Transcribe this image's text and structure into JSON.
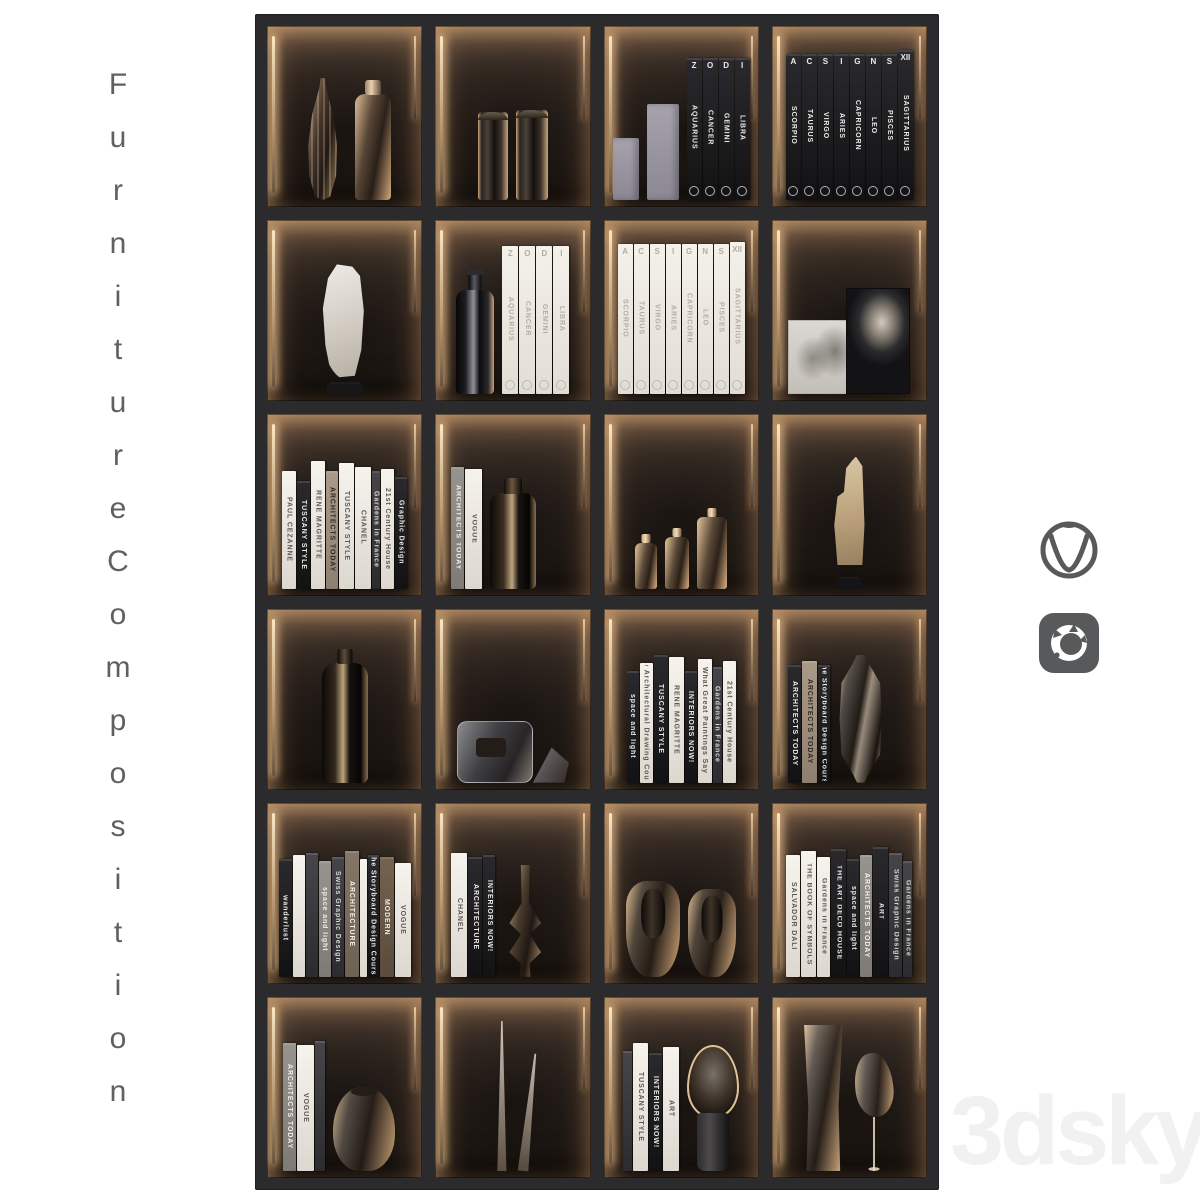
{
  "page": {
    "background": "#ffffff",
    "side_label": "Furniture Composition",
    "watermark": "3dsky"
  },
  "icons": {
    "vray": "vray-logo",
    "corona": "corona-renderer-logo"
  },
  "colors": {
    "frame": "#2b2b2d",
    "cell_glow": "#caa06e",
    "logo_gray": "#58595b",
    "label_gray": "#606060",
    "watermark_gray": "#f1f1f1"
  },
  "shelf": {
    "columns": 4,
    "rows": 6,
    "cells": [
      {
        "items": [
          {
            "k": "obj",
            "v": "amber-fluted-vase",
            "w": 48,
            "h": 122
          },
          {
            "k": "obj",
            "v": "amber-bottle",
            "w": 36,
            "h": 106
          }
        ]
      },
      {
        "items": [
          {
            "k": "obj",
            "v": "canister-dark",
            "w": 30,
            "h": 88
          },
          {
            "k": "obj",
            "v": "canister-dark",
            "w": 32,
            "h": 90
          }
        ]
      },
      {
        "items": [
          {
            "k": "obj",
            "v": "gray-box",
            "w": 26,
            "h": 62
          },
          {
            "k": "obj",
            "v": "gray-box",
            "w": 32,
            "h": 96
          },
          {
            "k": "books",
            "list": [
              {
                "t": "AQUARIUS",
                "top": "Z",
                "s": "black",
                "w": 15,
                "h": 142
              },
              {
                "t": "CANCER",
                "top": "O",
                "s": "black",
                "w": 15,
                "h": 142
              },
              {
                "t": "GEMINI",
                "top": "D",
                "s": "black",
                "w": 15,
                "h": 142
              },
              {
                "t": "LIBRA",
                "top": "I",
                "s": "black",
                "w": 15,
                "h": 142
              }
            ]
          }
        ]
      },
      {
        "items": [
          {
            "k": "books",
            "list": [
              {
                "t": "SCORPIO",
                "top": "A",
                "s": "black",
                "w": 15,
                "h": 146
              },
              {
                "t": "TAURUS",
                "top": "C",
                "s": "black",
                "w": 15,
                "h": 146
              },
              {
                "t": "VIRGO",
                "top": "S",
                "s": "black",
                "w": 15,
                "h": 146
              },
              {
                "t": "ARIES",
                "top": "I",
                "s": "black",
                "w": 15,
                "h": 146
              },
              {
                "t": "CAPRICORN",
                "top": "G",
                "s": "black",
                "w": 15,
                "h": 146
              },
              {
                "t": "LEO",
                "top": "N",
                "s": "black",
                "w": 15,
                "h": 146
              },
              {
                "t": "PISCES",
                "top": "S",
                "s": "black",
                "w": 15,
                "h": 146
              },
              {
                "t": "SAGITTARIUS",
                "top": "XII",
                "s": "black",
                "w": 15,
                "h": 150
              }
            ]
          }
        ]
      },
      {
        "items": [
          {
            "k": "obj",
            "v": "stone-slab",
            "w": 64,
            "h": 130
          }
        ]
      },
      {
        "items": [
          {
            "k": "obj",
            "v": "black-bottle",
            "w": 38,
            "h": 104
          },
          {
            "k": "books",
            "list": [
              {
                "t": "AQUARIUS",
                "top": "Z",
                "s": "zwhite",
                "w": 16,
                "h": 148
              },
              {
                "t": "CANCER",
                "top": "O",
                "s": "zwhite",
                "w": 16,
                "h": 148
              },
              {
                "t": "GEMINI",
                "top": "D",
                "s": "zwhite",
                "w": 16,
                "h": 148
              },
              {
                "t": "LIBRA",
                "top": "I",
                "s": "zwhite",
                "w": 16,
                "h": 148
              }
            ]
          }
        ]
      },
      {
        "items": [
          {
            "k": "books",
            "list": [
              {
                "t": "SCORPIO",
                "top": "A",
                "s": "zwhite",
                "w": 15,
                "h": 150
              },
              {
                "t": "TAURUS",
                "top": "C",
                "s": "zwhite",
                "w": 15,
                "h": 150
              },
              {
                "t": "VIRGO",
                "top": "S",
                "s": "zwhite",
                "w": 15,
                "h": 150
              },
              {
                "t": "ARIES",
                "top": "I",
                "s": "zwhite",
                "w": 15,
                "h": 150
              },
              {
                "t": "CAPRICORN",
                "top": "G",
                "s": "zwhite",
                "w": 15,
                "h": 150
              },
              {
                "t": "LEO",
                "top": "N",
                "s": "zwhite",
                "w": 15,
                "h": 150
              },
              {
                "t": "PISCES",
                "top": "S",
                "s": "zwhite",
                "w": 15,
                "h": 150
              },
              {
                "t": "SAGITTARIUS",
                "top": "XII",
                "s": "zwhite",
                "w": 15,
                "h": 152
              }
            ]
          }
        ]
      },
      {
        "items": [
          {
            "k": "obj",
            "v": "photo-tree",
            "w": 76,
            "h": 74
          },
          {
            "k": "obj",
            "v": "photo-portrait",
            "w": 64,
            "h": 106
          }
        ]
      },
      {
        "items": [
          {
            "k": "books",
            "list": [
              {
                "t": "PAUL CEZANNE",
                "s": "white",
                "w": 14,
                "h": 118
              },
              {
                "t": "TUSCANY STYLE",
                "s": "black",
                "w": 13,
                "h": 108
              },
              {
                "t": "RENÉ MAGRITTE",
                "s": "white",
                "w": 14,
                "h": 128
              },
              {
                "t": "ARCHITECTS TODAY",
                "s": "tan",
                "w": 12,
                "h": 118
              },
              {
                "t": "TUSCANY STYLE",
                "s": "white",
                "w": 15,
                "h": 126
              },
              {
                "t": "CHANEL",
                "s": "white",
                "w": 16,
                "h": 122
              },
              {
                "t": "Gardens in France",
                "s": "dark",
                "w": 8,
                "h": 118
              },
              {
                "t": "21st Century House",
                "s": "white",
                "w": 13,
                "h": 120
              },
              {
                "t": "Graphic Design",
                "s": "black",
                "w": 12,
                "h": 112
              }
            ]
          }
        ]
      },
      {
        "j": "start",
        "items": [
          {
            "k": "books",
            "list": [
              {
                "t": "ARCHITECTS TODAY",
                "s": "gray",
                "w": 13,
                "h": 122
              },
              {
                "t": "VOGUE",
                "s": "white",
                "w": 17,
                "h": 120
              }
            ]
          },
          {
            "k": "obj",
            "v": "dark-bottle-round",
            "w": 46,
            "h": 96
          }
        ]
      },
      {
        "items": [
          {
            "k": "obj",
            "v": "glass-bottle",
            "w": 22,
            "h": 46
          },
          {
            "k": "obj",
            "v": "glass-bottle",
            "w": 24,
            "h": 52
          },
          {
            "k": "obj",
            "v": "glass-bottle",
            "w": 30,
            "h": 72
          }
        ]
      },
      {
        "items": [
          {
            "k": "obj",
            "v": "driftwood",
            "w": 58,
            "h": 132
          }
        ]
      },
      {
        "items": [
          {
            "k": "obj",
            "v": "dark-bottle-tall",
            "w": 46,
            "h": 120
          }
        ]
      },
      {
        "items": [
          {
            "k": "obj",
            "v": "glass-plaque",
            "w": 76,
            "h": 62
          },
          {
            "k": "obj",
            "v": "glass-prism",
            "w": 36,
            "h": 40
          }
        ]
      },
      {
        "items": [
          {
            "k": "books",
            "list": [
              {
                "t": "space and light",
                "s": "black",
                "w": 12,
                "h": 112
              },
              {
                "t": "The Architectural Drawing Course",
                "s": "white",
                "w": 13,
                "h": 120
              },
              {
                "t": "TUSCANY STYLE",
                "s": "black",
                "w": 14,
                "h": 128
              },
              {
                "t": "RENÉ MAGRITTE",
                "s": "white",
                "w": 15,
                "h": 126
              },
              {
                "t": "INTERIORS NOW!",
                "s": "black",
                "w": 12,
                "h": 112
              },
              {
                "t": "What Great Paintings Say",
                "s": "white",
                "w": 14,
                "h": 124
              },
              {
                "t": "Gardens in France",
                "s": "dark",
                "w": 9,
                "h": 116
              },
              {
                "t": "21st Century House",
                "s": "white",
                "w": 13,
                "h": 122
              }
            ]
          }
        ]
      },
      {
        "j": "start",
        "items": [
          {
            "k": "books",
            "list": [
              {
                "t": "ARCHITECTS TODAY",
                "s": "black",
                "w": 13,
                "h": 118
              },
              {
                "t": "ARCHITECTS TODAY",
                "s": "tan",
                "w": 15,
                "h": 122
              },
              {
                "t": "The Storyboard Design Course",
                "s": "black",
                "w": 12,
                "h": 118
              }
            ]
          },
          {
            "k": "obj",
            "v": "glass-capsule",
            "w": 46,
            "h": 128
          }
        ]
      },
      {
        "items": [
          {
            "k": "books",
            "list": [
              {
                "t": "wanderlust",
                "s": "black",
                "w": 13,
                "h": 118
              },
              {
                "t": "",
                "s": "white",
                "w": 12,
                "h": 122
              },
              {
                "t": "",
                "s": "dark",
                "w": 12,
                "h": 124
              },
              {
                "t": "space and light",
                "s": "gray",
                "w": 12,
                "h": 116
              },
              {
                "t": "Swiss Graphic Design",
                "s": "dark",
                "w": 12,
                "h": 120
              },
              {
                "t": "ARCHITECTURE",
                "s": "taupe",
                "w": 14,
                "h": 126
              },
              {
                "t": "",
                "s": "white",
                "w": 7,
                "h": 118
              },
              {
                "t": "The Storyboard Design Course",
                "s": "black",
                "w": 11,
                "h": 122
              },
              {
                "t": "MODERN",
                "s": "brown",
                "w": 14,
                "h": 120
              },
              {
                "t": "VOGUE",
                "s": "white",
                "w": 16,
                "h": 114
              }
            ]
          }
        ]
      },
      {
        "j": "start",
        "items": [
          {
            "k": "books",
            "list": [
              {
                "t": "CHANEL",
                "s": "white",
                "w": 16,
                "h": 124
              },
              {
                "t": "ARCHITECTURE",
                "s": "black",
                "w": 14,
                "h": 120
              },
              {
                "t": "INTERIORS NOW!",
                "s": "black",
                "w": 12,
                "h": 122
              }
            ]
          },
          {
            "k": "obj",
            "v": "glass-candlestick",
            "w": 44,
            "h": 112
          }
        ]
      },
      {
        "items": [
          {
            "k": "obj",
            "v": "glass-vessel-capped",
            "w": 54,
            "h": 96
          },
          {
            "k": "obj",
            "v": "glass-vessel-capped",
            "w": 48,
            "h": 88
          }
        ]
      },
      {
        "items": [
          {
            "k": "books",
            "list": [
              {
                "t": "SALVADOR DALI",
                "s": "white",
                "w": 14,
                "h": 122
              },
              {
                "t": "THE BOOK OF SYMBOLS",
                "s": "white",
                "w": 15,
                "h": 126
              },
              {
                "t": "Gardens in France",
                "s": "white",
                "w": 13,
                "h": 120
              },
              {
                "t": "THE ART DECO HOUSE",
                "s": "black",
                "w": 15,
                "h": 128
              },
              {
                "t": "space and light",
                "s": "black",
                "w": 12,
                "h": 118
              },
              {
                "t": "ARCHITECTS TODAY",
                "s": "gray",
                "w": 12,
                "h": 122
              },
              {
                "t": "ART",
                "s": "black",
                "w": 15,
                "h": 130
              },
              {
                "t": "Swiss Graphic Design",
                "s": "dark",
                "w": 13,
                "h": 124
              },
              {
                "t": "Gardens in France",
                "s": "dark",
                "w": 9,
                "h": 116
              }
            ]
          }
        ]
      },
      {
        "j": "start",
        "items": [
          {
            "k": "books",
            "list": [
              {
                "t": "ARCHITECTS TODAY",
                "s": "gray",
                "w": 13,
                "h": 128
              },
              {
                "t": "VOGUE",
                "s": "white",
                "w": 17,
                "h": 126
              },
              {
                "t": "",
                "s": "dark",
                "w": 10,
                "h": 130
              }
            ]
          },
          {
            "k": "obj",
            "v": "glass-vase-round",
            "w": 62,
            "h": 84
          }
        ]
      },
      {
        "items": [
          {
            "k": "obj",
            "v": "glass-spike",
            "w": 12,
            "h": 150
          },
          {
            "k": "obj",
            "v": "glass-spike-lean",
            "w": 14,
            "h": 118
          }
        ]
      },
      {
        "items": [
          {
            "k": "books",
            "list": [
              {
                "t": "",
                "s": "dark",
                "w": 9,
                "h": 120
              },
              {
                "t": "TUSCANY STYLE",
                "s": "white",
                "w": 15,
                "h": 128
              },
              {
                "t": "INTERIORS NOW!",
                "s": "black",
                "w": 13,
                "h": 118
              },
              {
                "t": "ART",
                "s": "white",
                "w": 16,
                "h": 124
              }
            ]
          },
          {
            "k": "obj",
            "v": "mushroom-lamp",
            "w": 52,
            "h": 126
          }
        ]
      },
      {
        "items": [
          {
            "k": "obj",
            "v": "glass-cylinder-tall",
            "w": 42,
            "h": 146
          },
          {
            "k": "obj",
            "v": "glass-goblet",
            "w": 44,
            "h": 118
          }
        ]
      }
    ]
  }
}
